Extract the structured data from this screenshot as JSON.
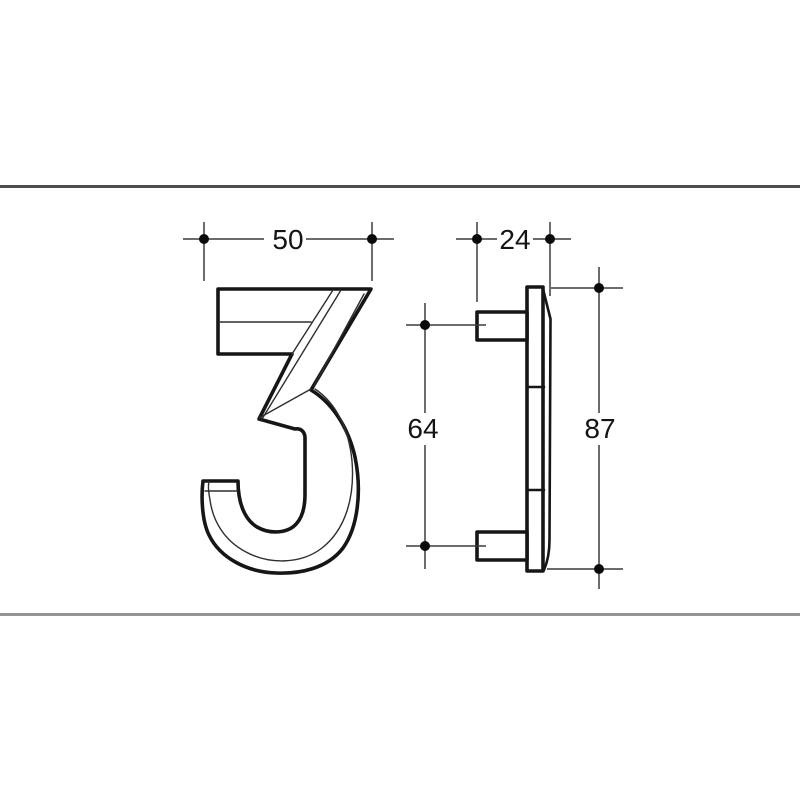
{
  "drawing": {
    "kind": "technical-dimension-drawing",
    "subject": "house-number-numeral",
    "numeral": "3",
    "dimensions": {
      "width": "50",
      "depth": "24",
      "stud_spacing": "64",
      "height": "87"
    },
    "colors": {
      "background": "#ffffff",
      "outline": "#161616",
      "dimension_line": "#3c3c3c",
      "marker_dot": "#0a0a0a",
      "rule_top": "#4d4d4d",
      "rule_bottom": "#949494"
    }
  }
}
